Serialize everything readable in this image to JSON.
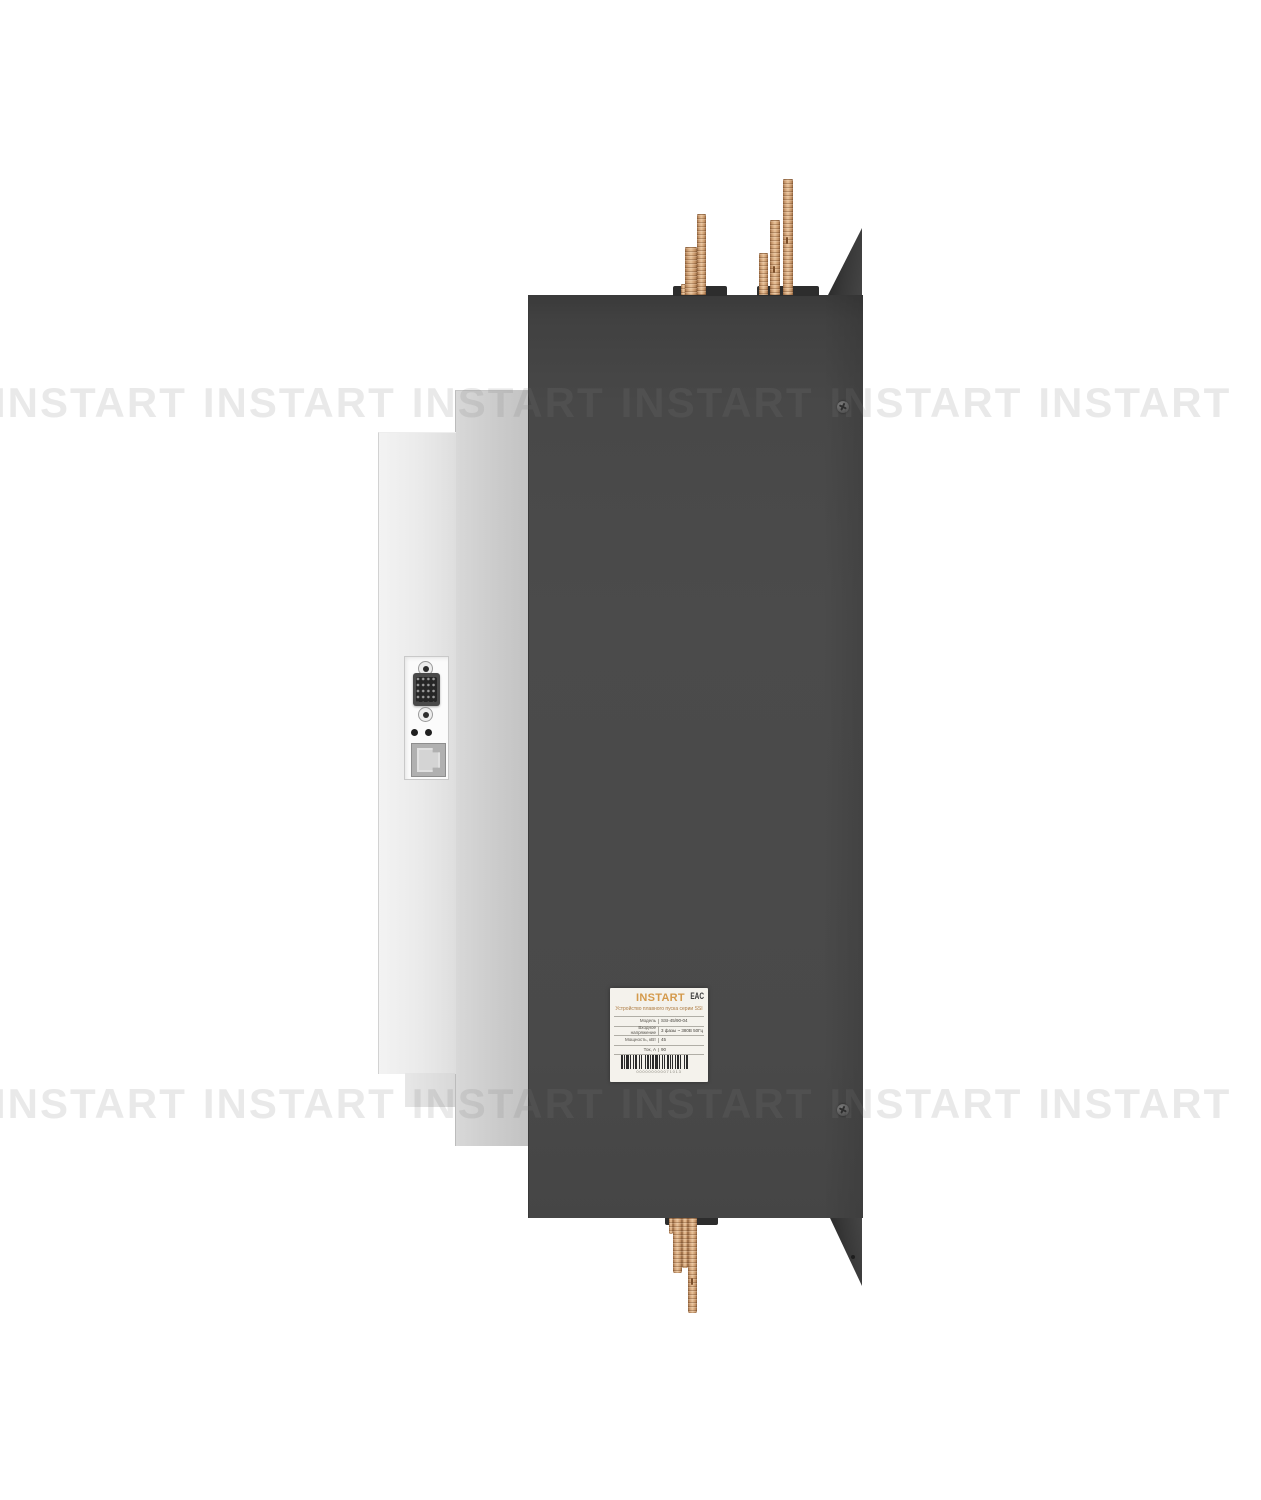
{
  "watermark": {
    "text": "INSTART",
    "rows": 2,
    "per_row": 6
  },
  "device_label": {
    "brand": "INSTART",
    "cert_mark": "EAC",
    "title": "Устройство плавного пуска серии SSI",
    "specs": [
      {
        "name": "Модель",
        "value": "SSI-45/90-04"
      },
      {
        "name": "Входное напряжение",
        "value": "3 фазы ~ 380В 50Гц"
      },
      {
        "name": "Мощность, кВт",
        "value": "45"
      },
      {
        "name": "Ток, А",
        "value": "90"
      }
    ],
    "barcode_number": "000000000071013"
  },
  "colors": {
    "brand_orange": "#d49a4c",
    "body_dark": "#474747",
    "copper": "#d8ab80",
    "panel_light": "#ebebeb",
    "panel_mid": "#cccccc",
    "watermark_gray": "#ebebeb"
  }
}
